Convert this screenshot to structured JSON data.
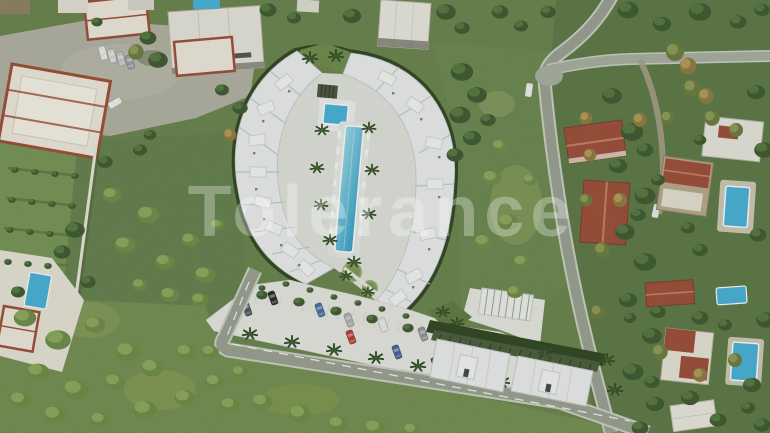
{
  "watermark": {
    "text": "Tolerance"
  },
  "colors": {
    "grass_base": "#6b874a",
    "scrub": "#7c9750",
    "woodland": "#57743f",
    "orchard": "#7fa058",
    "field": "#6e8c4e",
    "midleft_scrub": "#62804a",
    "building_white": "#edeff1",
    "concrete": "#b3b1a5",
    "road_asphalt": "#9aa094",
    "road_shoulder": "#ccd0c6",
    "pool_blue": "#45b1dc",
    "roof_red": "#9d4b37",
    "hedge_dark": "#2c431f",
    "watermark_white": "#ffffff"
  }
}
